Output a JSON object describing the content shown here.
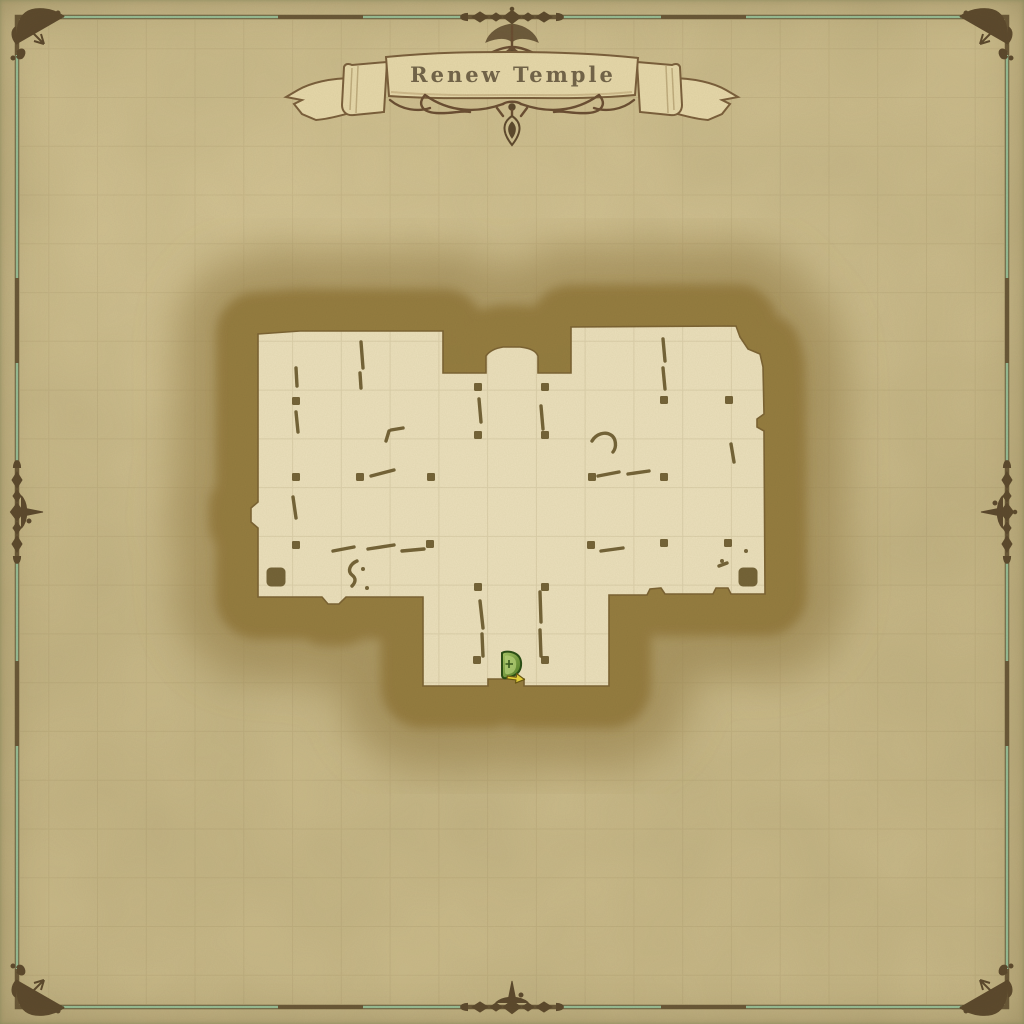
{
  "banner": {
    "title": "Renew Temple"
  },
  "border": {
    "green": "#9cc49c",
    "brown": "#6b5939",
    "ornament_ink": "#5d4a2e"
  },
  "palette": {
    "parchment": "#c7b786",
    "parchment_edge": "#b0a173",
    "floor": "#ebe0bc",
    "hatch_base": "#a28a4c",
    "hatch_line": "#82672e",
    "wall_ink": "#6a592c",
    "banner_fill": "#e6d8aa",
    "banner_outline": "#7b603c",
    "title_ink": "#6a5c42",
    "marker_green_dark": "#2c4f16",
    "marker_green_light": "#9cc653",
    "marker_arrow_yellow": "#e8d33c"
  },
  "grid": {
    "cells": 21
  },
  "temple": {
    "outline_path": "M258,334 L300,331 L443,331 L443,373 L486,373 L486,356 C490,350 497,348 503,347 L520,347 C530,348 536,351 538,356 L538,373 L571,373 L571,327 L736,326 L740,337 L748,349 L760,354 L763,367 L764,414 L757,419 L757,427 L764,431 L765,594 L731,594 L728,588 L716,588 L713,594 L665,594 L661,588 L650,589 L647,595 L609,595 L609,686 L524,686 L524,679 L488,679 L488,686 L423,686 L423,597 L346,597 L339,604 L328,604 L322,597 L258,597 L258,528 L251,522 L251,508 L258,502 Z",
    "pillar_size": 8,
    "pillar_large_size": 19,
    "pillars_small": [
      [
        296,
        401
      ],
      [
        664,
        400
      ],
      [
        729,
        400
      ],
      [
        478,
        387
      ],
      [
        545,
        387
      ],
      [
        478,
        435
      ],
      [
        545,
        435
      ],
      [
        296,
        477
      ],
      [
        360,
        477
      ],
      [
        431,
        477
      ],
      [
        592,
        477
      ],
      [
        664,
        477
      ],
      [
        296,
        545
      ],
      [
        430,
        544
      ],
      [
        591,
        545
      ],
      [
        664,
        543
      ],
      [
        728,
        543
      ],
      [
        478,
        587
      ],
      [
        545,
        587
      ],
      [
        477,
        660
      ],
      [
        545,
        660
      ]
    ],
    "pillars_large": [
      [
        276,
        577
      ],
      [
        748,
        577
      ]
    ],
    "wall_dashes": [
      [
        361,
        342,
        363,
        368
      ],
      [
        360,
        373,
        361,
        388
      ],
      [
        296,
        368,
        297,
        386
      ],
      [
        296,
        412,
        298,
        432
      ],
      [
        386,
        441,
        389,
        431
      ],
      [
        391,
        430,
        403,
        428
      ],
      [
        371,
        476,
        394,
        470
      ],
      [
        293,
        497,
        296,
        518
      ],
      [
        333,
        551,
        354,
        547
      ],
      [
        368,
        549,
        394,
        545
      ],
      [
        402,
        551,
        424,
        549
      ],
      [
        480,
        601,
        483,
        628
      ],
      [
        482,
        634,
        483,
        656
      ],
      [
        540,
        592,
        541,
        622
      ],
      [
        540,
        630,
        541,
        656
      ],
      [
        479,
        399,
        481,
        422
      ],
      [
        541,
        406,
        543,
        429
      ],
      [
        663,
        339,
        665,
        361
      ],
      [
        663,
        368,
        665,
        389
      ],
      [
        598,
        476,
        619,
        472
      ],
      [
        628,
        474,
        649,
        471
      ],
      [
        601,
        551,
        623,
        548
      ],
      [
        731,
        444,
        734,
        462
      ],
      [
        719,
        566,
        727,
        563
      ]
    ],
    "wall_curves": [
      "M357,561 C350,564 347,571 352,575 C356,578 356,582 352,586",
      "M592,441 C596,434 605,431 611,435 C616,438 617,447 613,452"
    ],
    "wall_dots": [
      [
        363,
        569
      ],
      [
        746,
        551
      ],
      [
        367,
        588
      ],
      [
        722,
        561
      ]
    ]
  },
  "markers": {
    "exit": {
      "name": "exit-door-marker",
      "x": 499,
      "y": 651
    }
  }
}
